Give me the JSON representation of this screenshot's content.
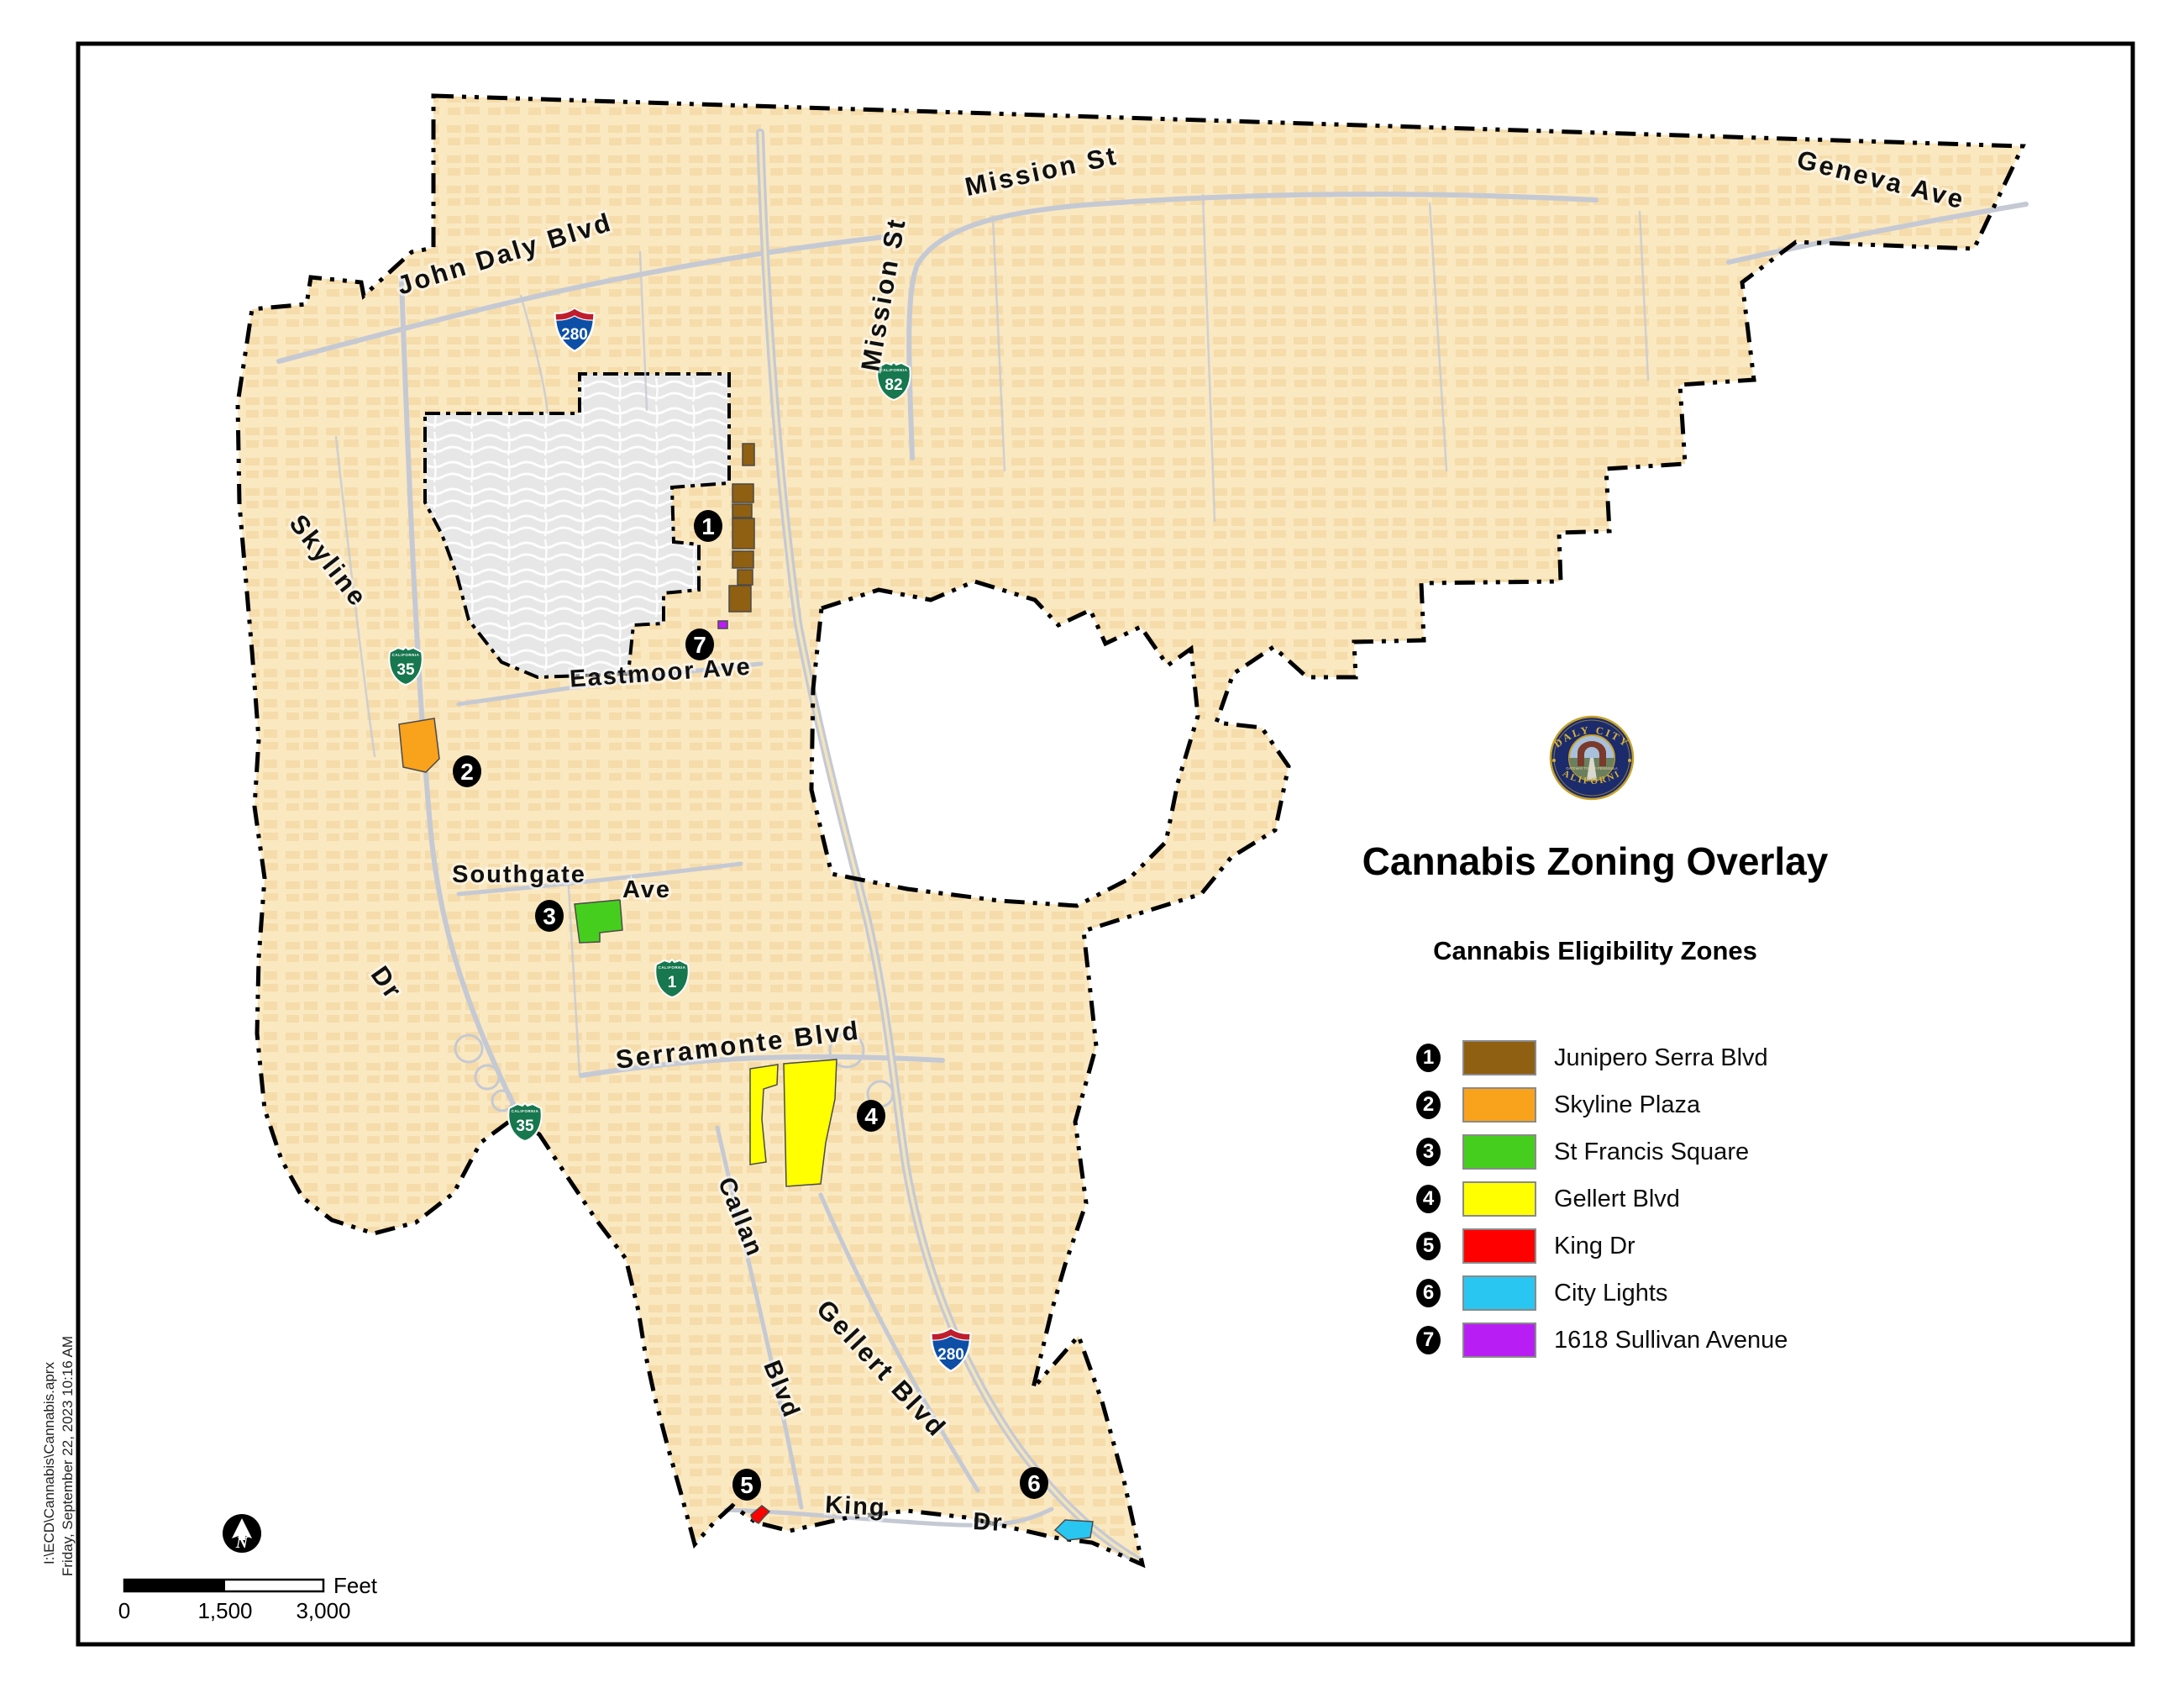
{
  "map": {
    "road_labels": [
      {
        "text": "John Daly Blvd"
      },
      {
        "text": "Mission St"
      },
      {
        "text": "Mission St"
      },
      {
        "text": "Geneva Ave"
      },
      {
        "text": "Skyline"
      },
      {
        "text": "Dr"
      },
      {
        "text": "Eastmoor Ave"
      },
      {
        "text": "Southgate"
      },
      {
        "text": "Ave"
      },
      {
        "text": "Serramonte Blvd"
      },
      {
        "text": "Callan"
      },
      {
        "text": "Blvd"
      },
      {
        "text": "Gellert Blvd"
      },
      {
        "text": "King"
      },
      {
        "text": "Dr"
      }
    ],
    "shields": [
      {
        "system": "interstate",
        "label": "280"
      },
      {
        "system": "interstate",
        "label": "280"
      },
      {
        "system": "california",
        "label": "35"
      },
      {
        "system": "california",
        "label": "35"
      },
      {
        "system": "california",
        "label": "1"
      },
      {
        "system": "california",
        "label": "82"
      }
    ],
    "shield_state_label": "CALIFORNIA",
    "colors": {
      "land": "#FAE8C1",
      "land_texture": "#EFCF92",
      "excluded_area": "#E7E7E7",
      "road": "#C5C9D3",
      "boundary": "#000000"
    }
  },
  "seal": {
    "top": "DALY CITY",
    "bottom": "CALIFORNIA",
    "center": "GATEWAY TO THE PENINSULA"
  },
  "legend": {
    "title": "Cannabis Zoning Overlay",
    "subtitle": "Cannabis Eligibility Zones",
    "items": [
      {
        "number": "1",
        "label": "Junipero Serra Blvd",
        "color": "#8F5F12"
      },
      {
        "number": "2",
        "label": "Skyline Plaza",
        "color": "#F9A21B"
      },
      {
        "number": "3",
        "label": "St Francis Square",
        "color": "#46CE1E"
      },
      {
        "number": "4",
        "label": "Gellert Blvd",
        "color": "#FFFF00"
      },
      {
        "number": "5",
        "label": "King Dr",
        "color": "#FE0000"
      },
      {
        "number": "6",
        "label": "City Lights",
        "color": "#2AC6F2"
      },
      {
        "number": "7",
        "label": "1618 Sullivan Avenue",
        "color": "#B81EF3"
      }
    ]
  },
  "scale_bar": {
    "ticks": [
      "0",
      "1,500",
      "3,000"
    ],
    "unit": "Feet"
  },
  "north_arrow": {
    "label": "N"
  },
  "footer": {
    "path": "I:\\ECD\\Cannabis\\Cannabis.aprx",
    "datetime": "Friday, September 22, 2023 10:16 AM"
  }
}
